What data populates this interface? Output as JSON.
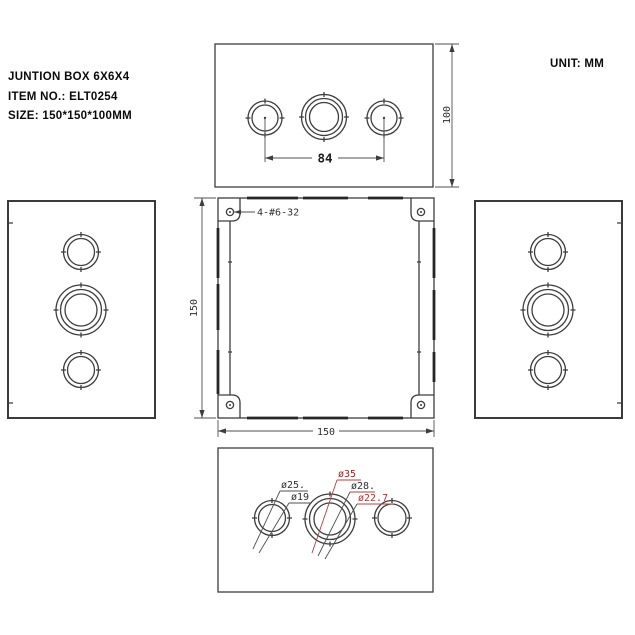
{
  "title_block": {
    "line1": "JUNTION BOX 6X6X4",
    "line2": "ITEM NO.: ELT0254",
    "line3": "SIZE: 150*150*100MM"
  },
  "unit_label": "UNIT: MM",
  "views": {
    "top": {
      "dim_spacing": "84",
      "dim_depth": "100"
    },
    "front": {
      "screw_note": "4-#6-32",
      "dim_width": "150",
      "dim_height": "150"
    },
    "bottom": {
      "labels": {
        "d25": "ø25.",
        "d19": "ø19",
        "d35": "ø35",
        "d28": "ø28.",
        "d22_7": "ø22.7"
      }
    }
  },
  "colors": {
    "line": "#3d3d3d",
    "red_label": "#b03434",
    "dark_red_label": "#992626"
  }
}
